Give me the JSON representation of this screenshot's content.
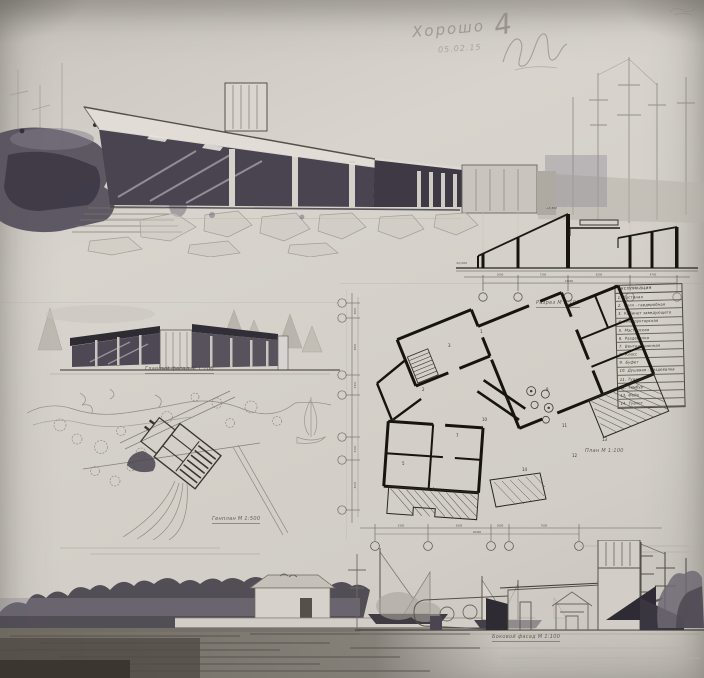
{
  "annotations": {
    "grade_word": "Хорошо",
    "grade_mark": "4",
    "grade_date": "05.02.15"
  },
  "captions": {
    "section": "Разрез  М 1:100",
    "main_facade": "Главный фасад  М 1:100",
    "plan": "План  М 1:100",
    "site_plan": "Генплан  М 1:500",
    "side_facade": "Боковой фасад  М 1:100"
  },
  "legend": {
    "title": "Экспликация",
    "items": [
      {
        "num": "1",
        "label": "Гостиная"
      },
      {
        "num": "2",
        "label": "Холл - гардеробная"
      },
      {
        "num": "3",
        "label": "Кабинет заведующего"
      },
      {
        "num": "4",
        "label": "Инструкторская"
      },
      {
        "num": "5",
        "label": "Мастерская"
      },
      {
        "num": "6",
        "label": "Раздевалка"
      },
      {
        "num": "7",
        "label": "Вентиляционная"
      },
      {
        "num": "8",
        "label": "Класс"
      },
      {
        "num": "9",
        "label": "Буфет"
      },
      {
        "num": "10",
        "label": "Душевая - раздевалка"
      },
      {
        "num": "11",
        "label": "Туалет"
      },
      {
        "num": "12",
        "label": "Тамбур"
      },
      {
        "num": "13",
        "label": "Фойе"
      },
      {
        "num": "14",
        "label": "Туалет"
      }
    ]
  },
  "section": {
    "level_top": "+3,300",
    "level_zero": "±0,000",
    "dims": [
      "3500",
      "7200",
      "6200",
      "4700"
    ],
    "total": "21600"
  },
  "plan": {
    "room_numbers": [
      {
        "n": "1",
        "x": 150,
        "y": 48
      },
      {
        "n": "3",
        "x": 118,
        "y": 62
      },
      {
        "n": "2",
        "x": 92,
        "y": 106
      },
      {
        "n": "4",
        "x": 62,
        "y": 136
      },
      {
        "n": "5",
        "x": 72,
        "y": 180
      },
      {
        "n": "6",
        "x": 102,
        "y": 206
      },
      {
        "n": "7",
        "x": 126,
        "y": 152
      },
      {
        "n": "10",
        "x": 152,
        "y": 136
      },
      {
        "n": "9",
        "x": 176,
        "y": 116
      },
      {
        "n": "8",
        "x": 216,
        "y": 106
      },
      {
        "n": "11",
        "x": 232,
        "y": 142
      },
      {
        "n": "12",
        "x": 242,
        "y": 172
      },
      {
        "n": "13",
        "x": 272,
        "y": 156
      },
      {
        "n": "14",
        "x": 192,
        "y": 186
      }
    ],
    "dims_bottom": [
      "5300",
      "6300",
      "1800",
      "7000"
    ],
    "total_bottom": "20400",
    "dims_left": [
      "3600",
      "4800",
      "2400",
      "5200",
      "4000"
    ]
  },
  "colors": {
    "paper": "#d4d0c9",
    "ink": "#1c1915",
    "pencil": "#8f8a82",
    "wash_dark": "#4b4650",
    "water": "#6e6961"
  }
}
